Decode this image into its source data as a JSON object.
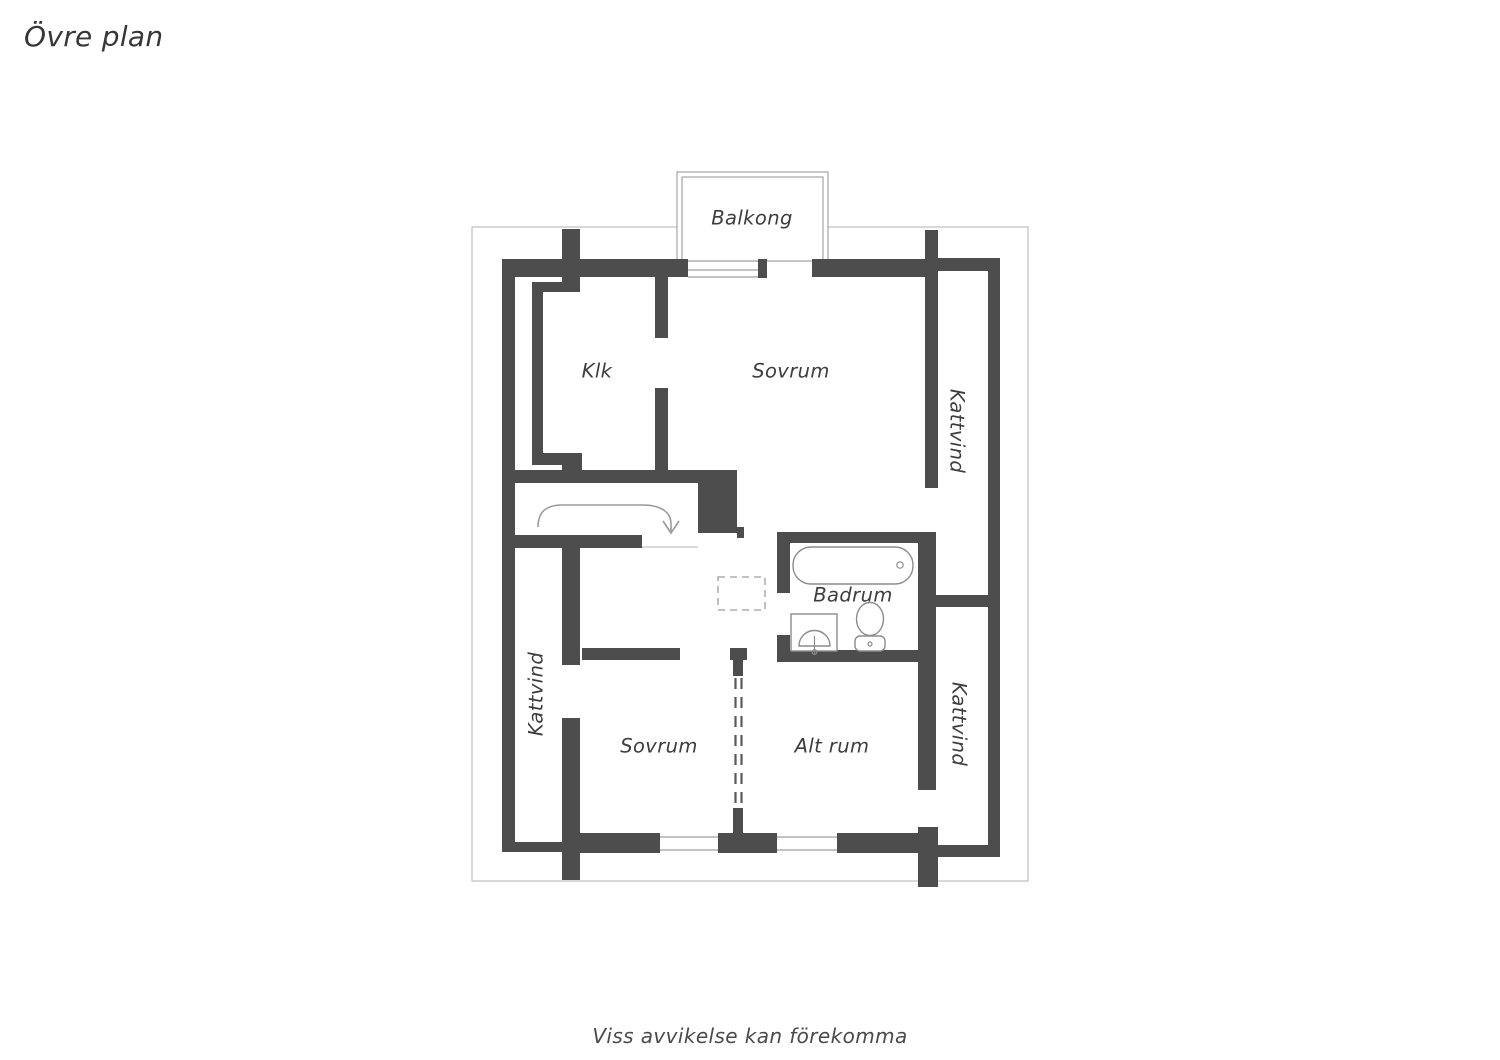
{
  "header": {
    "title": "Övre plan"
  },
  "footer": {
    "disclaimer": "Viss avvikelse kan förekomma"
  },
  "floorplan": {
    "rooms": {
      "balkong": "Balkong",
      "klk": "Klk",
      "sovrum_upper": "Sovrum",
      "kattvind_right_upper": "Kattvind",
      "kattvind_left": "Kattvind",
      "badrum": "Badrum",
      "sovrum_lower": "Sovrum",
      "alt_rum": "Alt rum",
      "kattvind_right_lower": "Kattvind"
    },
    "fixtures": [
      "bathtub-icon",
      "sink-icon",
      "toilet-icon",
      "stairs-direction-arrow-icon",
      "chimney-shaft-dashed",
      "window-symbol",
      "dashed-opening"
    ],
    "colors": {
      "wall": "#4d4d4d",
      "outer_boundary": "#bdbdbd",
      "fixture_outline": "#8c8c8c",
      "text": "#3d3d3d"
    }
  }
}
